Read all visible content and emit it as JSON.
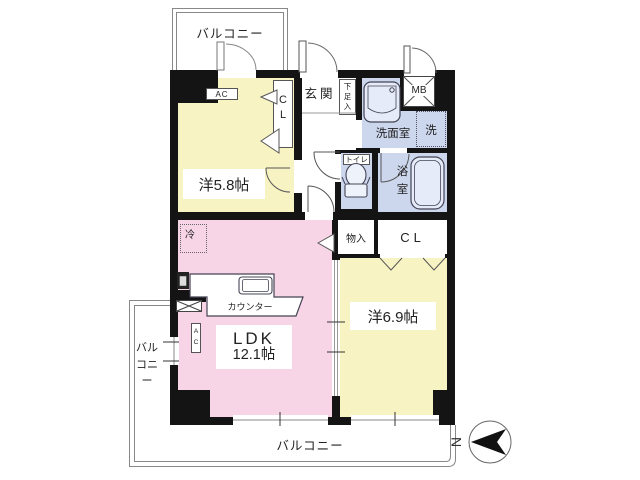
{
  "plan": {
    "type": "apartment-floor-plan",
    "colors": {
      "wall": "#141414",
      "room_yellow": "#f8f3c3",
      "room_pink": "#f8d5e6",
      "room_blue": "#ccd7ee",
      "fixture_fill": "#e5ebf8",
      "outline_gray": "#888888"
    },
    "labels": {
      "balcony_top": "バルコニー",
      "balcony_left": "バルコニー",
      "balcony_bottom": "バルコニー",
      "room1": "洋5.8帖",
      "room2": "洋6.9帖",
      "ldk_line1": "LDK",
      "ldk_line2": "12.1帖",
      "entrance": "玄関",
      "shoe_box": "下足入",
      "meter_box": "MB",
      "washroom": "洗面室",
      "washer": "洗",
      "toilet": "トイレ",
      "bath": "浴室",
      "closet1": "CL",
      "closet2": "CL",
      "storage": "物入",
      "fridge": "冷",
      "ac_room1": "AC",
      "ac_ldk": "AC",
      "counter": "カウンター",
      "north": "N"
    }
  }
}
